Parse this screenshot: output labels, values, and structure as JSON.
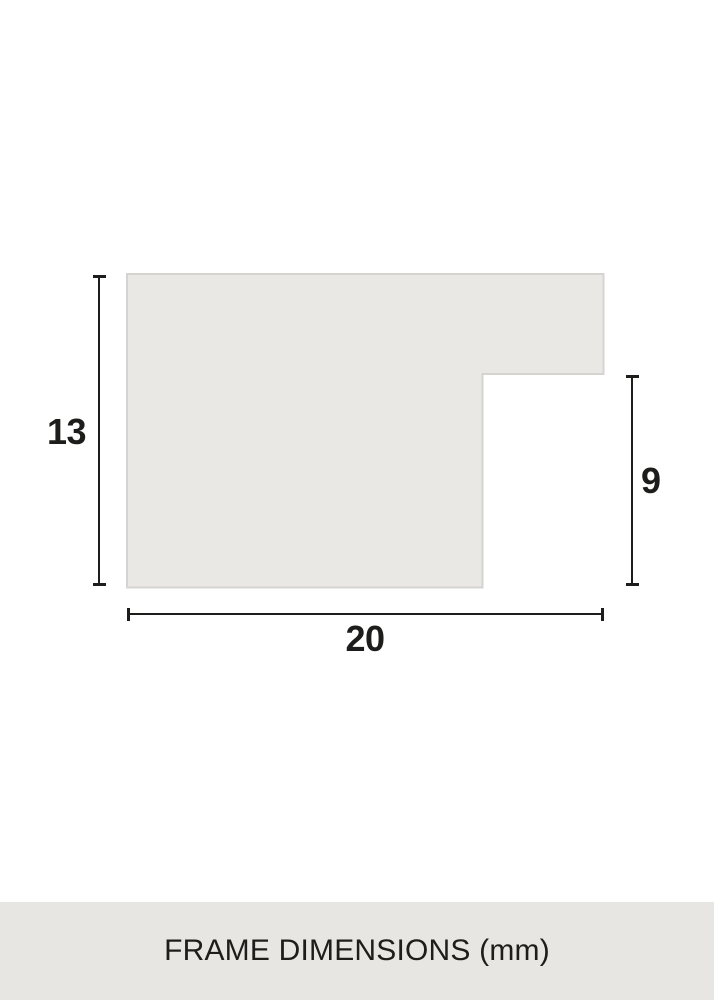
{
  "diagram": {
    "labels": {
      "height": "13",
      "rabbet": "9",
      "width": "20"
    },
    "footer": {
      "title": "FRAME DIMENSIONS (mm)"
    },
    "colors": {
      "background": "#ffffff",
      "profile_fill": "#e9e8e4",
      "profile_border": "#d5d4d0",
      "line": "#1d1d1b",
      "text": "#1d1d1b",
      "footer_bg": "#e7e6e2"
    }
  }
}
